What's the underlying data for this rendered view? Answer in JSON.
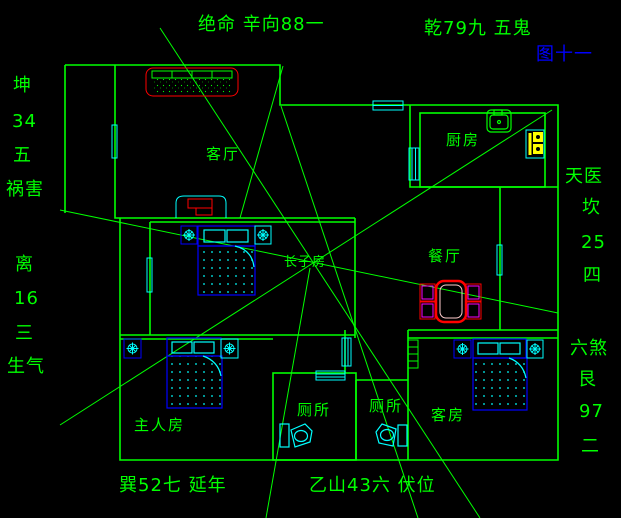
{
  "figure_label": "图十一",
  "compass": {
    "top_left": "绝命 辛向88一",
    "top_right": "乾79九 五鬼",
    "bottom_left": "巽52七 延年",
    "bottom_right": "乙山43六 伏位",
    "left_upper": [
      "坤",
      "34",
      "五",
      "祸害"
    ],
    "left_lower": [
      "离",
      "16",
      "三",
      "生气"
    ],
    "right_upper": [
      "天医",
      "坎",
      "25",
      "四"
    ],
    "right_lower": [
      "六煞",
      "艮",
      "97",
      "二"
    ]
  },
  "rooms": {
    "living": "客厅",
    "kitchen": "厨房",
    "dining": "餐厅",
    "eldest_son": "长子房",
    "master": "主人房",
    "toilet1": "厕所",
    "toilet2": "厕所",
    "guest": "客房"
  },
  "colors": {
    "background": "#000000",
    "wall": "#00ff00",
    "window": "#00ffff",
    "furniture_blue": "#0000ff",
    "accent_red": "#ff0000",
    "accent_magenta": "#ff00ff",
    "accent_yellow": "#ffff00",
    "figure_blue": "#0000ff"
  }
}
